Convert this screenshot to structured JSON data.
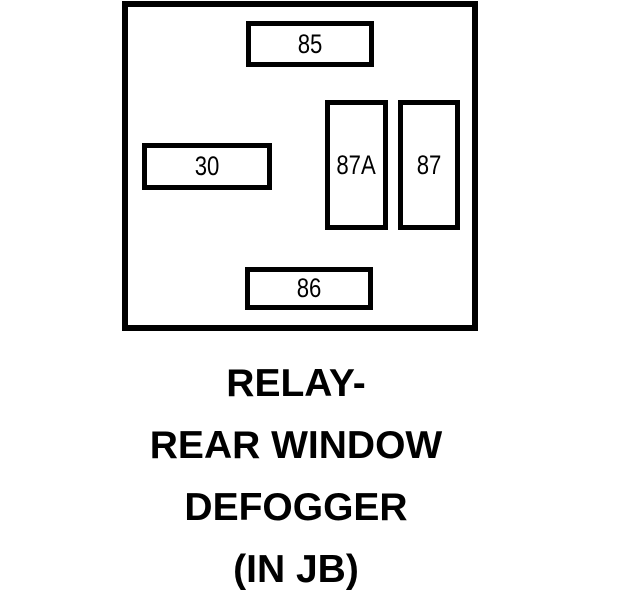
{
  "colors": {
    "ink": "#000000",
    "paper": "#ffffff"
  },
  "relay": {
    "terminals": [
      {
        "id": "85",
        "label": "85"
      },
      {
        "id": "30",
        "label": "30"
      },
      {
        "id": "87A",
        "label": "87A"
      },
      {
        "id": "87",
        "label": "87"
      },
      {
        "id": "86",
        "label": "86"
      }
    ]
  },
  "caption": {
    "line1": "RELAY-",
    "line2": "REAR WINDOW",
    "line3": "DEFOGGER",
    "line4": "(IN JB)"
  }
}
